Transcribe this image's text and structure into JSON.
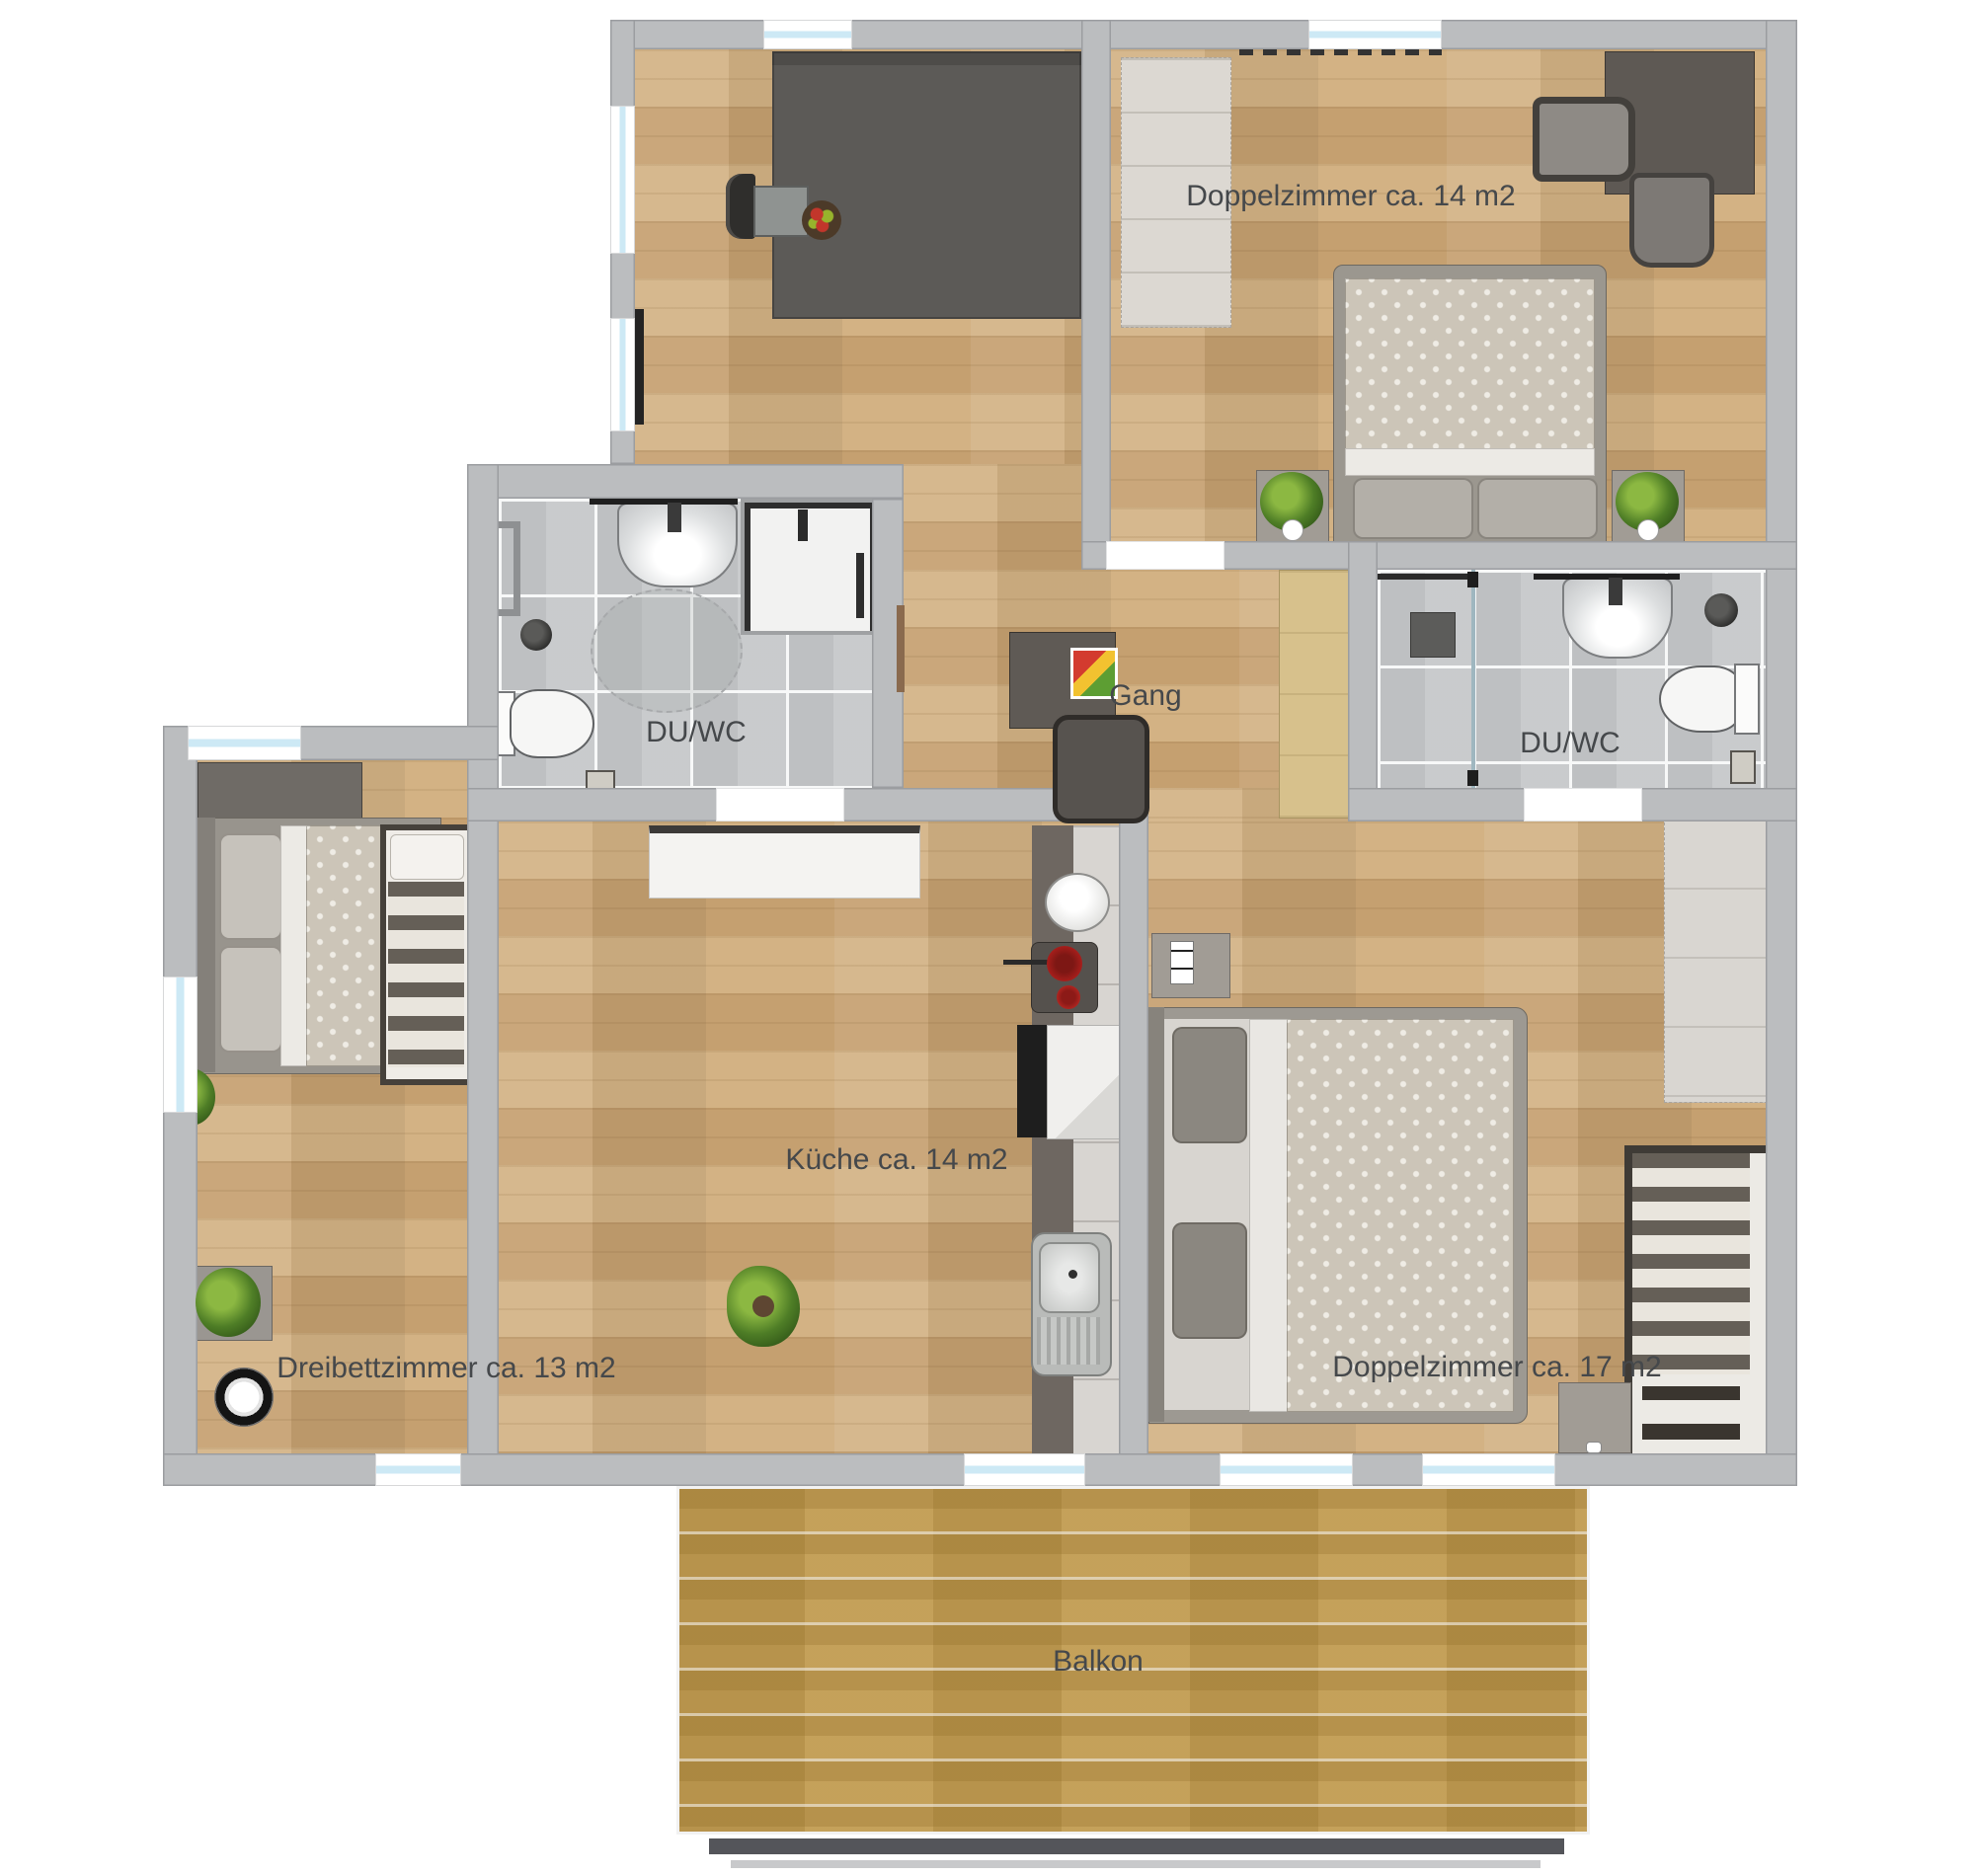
{
  "title": "Apartment floor plan",
  "colors": {
    "wall": "#bbbdbf",
    "wood_floor": "#cdaa7c",
    "tile_floor": "#c6c8ca",
    "balcony_floor": "#c19b50",
    "window_glass": "#cde9f5",
    "label_text": "#45484b"
  },
  "rooms": {
    "doppelzimmer_14": {
      "label": "Doppelzimmer ca. 14 m2"
    },
    "gang": {
      "label": "Gang"
    },
    "du_wc_left": {
      "label": "DU/WC"
    },
    "du_wc_right": {
      "label": "DU/WC"
    },
    "kueche": {
      "label": "Küche ca. 14 m2"
    },
    "dreibettzimmer": {
      "label": "Dreibettzimmer ca. 13 m2"
    },
    "doppelzimmer_17": {
      "label": "Doppelzimmer ca. 17 m2"
    },
    "balkon": {
      "label": "Balkon"
    }
  }
}
